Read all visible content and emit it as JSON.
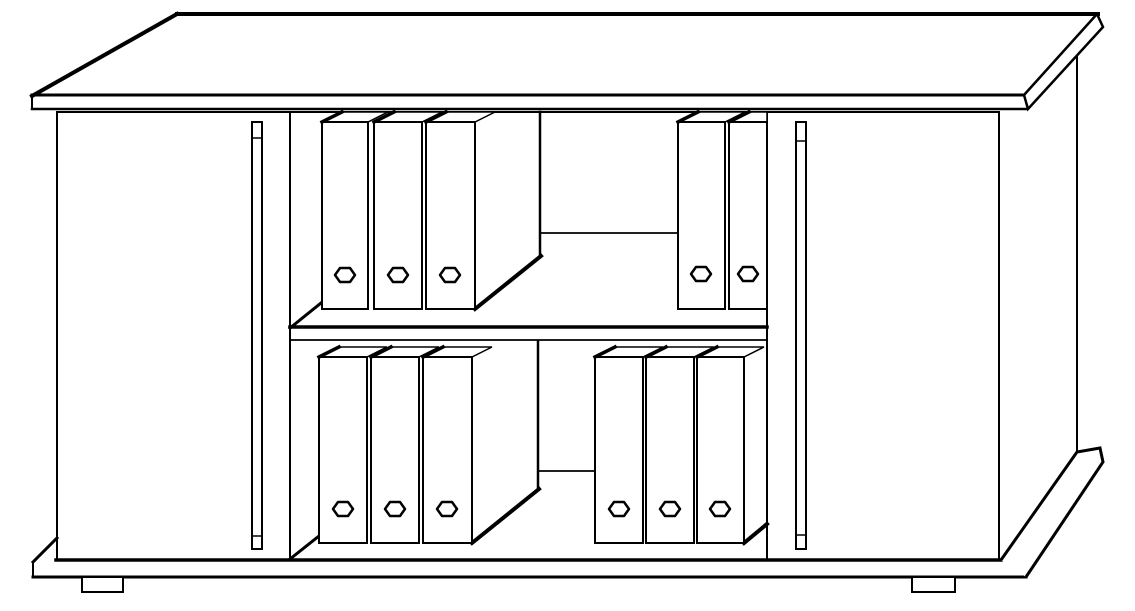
{
  "figure": {
    "description": "Black-and-white line drawing of a sideboard cabinet with two closed doors, an open middle bay with one shelf, and eleven ring binders",
    "binder_count": 11,
    "door_count": 2,
    "shelf_count": 1
  },
  "drawing": {
    "background": "#ffffff",
    "ink": "#000000",
    "width": 1135,
    "height": 611,
    "shapes": [
      {
        "type": "line",
        "name": "tabletop-back-edge",
        "x1": 177,
        "y1": 14,
        "x2": 1098,
        "y2": 14,
        "w": 4
      },
      {
        "type": "line",
        "name": "tabletop-left-edge",
        "x1": 32,
        "y1": 96,
        "x2": 177,
        "y2": 14,
        "w": 4
      },
      {
        "type": "line",
        "name": "tabletop-front-edge",
        "x1": 32,
        "y1": 95,
        "x2": 1024,
        "y2": 95,
        "w": 3
      },
      {
        "type": "line",
        "name": "tabletop-front-band-bottom",
        "x1": 32,
        "y1": 109,
        "x2": 1026,
        "y2": 109,
        "w": 2.5
      },
      {
        "type": "line",
        "name": "tabletop-left-end-cap",
        "x1": 32,
        "y1": 95,
        "x2": 32,
        "y2": 109,
        "w": 2
      },
      {
        "type": "polygon",
        "name": "tabletop-right-end-face",
        "points": [
          [
            1024,
            95
          ],
          [
            1097,
            14
          ],
          [
            1103,
            27
          ],
          [
            1028,
            109
          ]
        ],
        "w": 2.5
      },
      {
        "type": "line",
        "name": "carcass-top-edge",
        "x1": 57,
        "y1": 112,
        "x2": 999,
        "y2": 112,
        "w": 2
      },
      {
        "type": "line",
        "name": "carcass-left-edge",
        "x1": 57,
        "y1": 112,
        "x2": 57,
        "y2": 560,
        "w": 2
      },
      {
        "type": "line",
        "name": "left-door-right-edge",
        "x1": 290,
        "y1": 112,
        "x2": 290,
        "y2": 560,
        "w": 2
      },
      {
        "type": "line",
        "name": "right-door-left-edge",
        "x1": 767,
        "y1": 112,
        "x2": 767,
        "y2": 560,
        "w": 2
      },
      {
        "type": "line",
        "name": "right-door-right-edge",
        "x1": 999,
        "y1": 112,
        "x2": 999,
        "y2": 560,
        "w": 2
      },
      {
        "type": "line",
        "name": "carcass-right-silhouette",
        "x1": 1077,
        "y1": 57,
        "x2": 1077,
        "y2": 452,
        "w": 2
      },
      {
        "type": "line",
        "name": "carcass-bottom-edge",
        "x1": 56,
        "y1": 560,
        "x2": 1001,
        "y2": 560,
        "w": 3.5
      },
      {
        "type": "rect",
        "name": "left-door-handle",
        "x": 252,
        "y": 122,
        "wd": 10,
        "h": 427,
        "w": 2
      },
      {
        "type": "line",
        "name": "left-door-handle-top-cap",
        "x1": 252,
        "y1": 138,
        "x2": 262,
        "y2": 138,
        "w": 1.5
      },
      {
        "type": "line",
        "name": "left-door-handle-bottom-cap",
        "x1": 252,
        "y1": 536,
        "x2": 262,
        "y2": 536,
        "w": 1.5
      },
      {
        "type": "rect",
        "name": "right-door-handle",
        "x": 796,
        "y": 122,
        "wd": 10,
        "h": 427,
        "w": 2
      },
      {
        "type": "line",
        "name": "right-door-handle-top-cap",
        "x1": 796,
        "y1": 141,
        "x2": 806,
        "y2": 141,
        "w": 1.5
      },
      {
        "type": "line",
        "name": "right-door-handle-bottom-cap",
        "x1": 796,
        "y1": 535,
        "x2": 806,
        "y2": 535,
        "w": 1.5
      },
      {
        "type": "line",
        "name": "shelf-front-edge",
        "x1": 290,
        "y1": 327,
        "x2": 767,
        "y2": 327,
        "w": 3.5
      },
      {
        "type": "line",
        "name": "shelf-front-band-bottom",
        "x1": 290,
        "y1": 340,
        "x2": 767,
        "y2": 340,
        "w": 1.8
      },
      {
        "type": "line",
        "name": "upper-shelf-left-corner-diagonal",
        "x1": 290,
        "y1": 328,
        "x2": 321,
        "y2": 303,
        "w": 3
      },
      {
        "type": "line",
        "name": "upper-binder-block-back-edge",
        "x1": 540,
        "y1": 112,
        "x2": 540,
        "y2": 257,
        "w": 2.5
      },
      {
        "type": "line",
        "name": "upper-back-wall-shelf-junction",
        "x1": 540,
        "y1": 233,
        "x2": 678,
        "y2": 233,
        "w": 1.8
      },
      {
        "type": "line",
        "name": "upper-binder-block-side-bottom-diagonal",
        "x1": 475,
        "y1": 309,
        "x2": 541,
        "y2": 256,
        "w": 4
      },
      {
        "type": "line",
        "name": "lower-floor-left-corner-diagonal",
        "x1": 290,
        "y1": 559,
        "x2": 319,
        "y2": 536,
        "w": 3
      },
      {
        "type": "line",
        "name": "lower-binder-block-back-edge",
        "x1": 538,
        "y1": 341,
        "x2": 538,
        "y2": 490,
        "w": 2.5
      },
      {
        "type": "line",
        "name": "lower-back-wall-floor-junction",
        "x1": 538,
        "y1": 471,
        "x2": 595,
        "y2": 471,
        "w": 1.8
      },
      {
        "type": "line",
        "name": "lower-binder-block-side-bottom-diagonal",
        "x1": 472,
        "y1": 543,
        "x2": 539,
        "y2": 489,
        "w": 4
      },
      {
        "type": "line",
        "name": "lower-right-binder-side-bottom-diagonal",
        "x1": 744,
        "y1": 543,
        "x2": 767,
        "y2": 524,
        "w": 4
      },
      {
        "type": "polygon",
        "name": "binder-top-upper-left-1",
        "points": [
          [
            322,
            122
          ],
          [
            342,
            112
          ],
          [
            388,
            112
          ],
          [
            368,
            122
          ]
        ],
        "w": 1.5
      },
      {
        "type": "rect",
        "name": "binder-front-upper-left-1",
        "x": 322,
        "y": 122,
        "wd": 46,
        "h": 187,
        "w": 2
      },
      {
        "type": "line",
        "name": "binder-spine-edge-upper-left-1",
        "x1": 322,
        "y1": 122,
        "x2": 342,
        "y2": 112,
        "w": 3.5
      },
      {
        "type": "hex",
        "name": "binder-grip-hole-upper-left-1",
        "cx": 345,
        "cy": 275,
        "rx": 10,
        "ry": 7,
        "w": 2.5
      },
      {
        "type": "polygon",
        "name": "binder-top-upper-left-2",
        "points": [
          [
            374,
            122
          ],
          [
            394,
            112
          ],
          [
            442,
            112
          ],
          [
            422,
            122
          ]
        ],
        "w": 1.5
      },
      {
        "type": "rect",
        "name": "binder-front-upper-left-2",
        "x": 374,
        "y": 122,
        "wd": 48,
        "h": 187,
        "w": 2
      },
      {
        "type": "line",
        "name": "binder-spine-edge-upper-left-2",
        "x1": 374,
        "y1": 122,
        "x2": 394,
        "y2": 112,
        "w": 3.5
      },
      {
        "type": "hex",
        "name": "binder-grip-hole-upper-left-2",
        "cx": 398,
        "cy": 275,
        "rx": 10,
        "ry": 7,
        "w": 2.5
      },
      {
        "type": "polygon",
        "name": "binder-top-upper-left-3",
        "points": [
          [
            426,
            122
          ],
          [
            446,
            112
          ],
          [
            495,
            112
          ],
          [
            475,
            122
          ]
        ],
        "w": 1.5
      },
      {
        "type": "rect",
        "name": "binder-front-upper-left-3",
        "x": 426,
        "y": 122,
        "wd": 49,
        "h": 187,
        "w": 2
      },
      {
        "type": "line",
        "name": "binder-spine-edge-upper-left-3",
        "x1": 426,
        "y1": 122,
        "x2": 446,
        "y2": 112,
        "w": 3.5
      },
      {
        "type": "hex",
        "name": "binder-grip-hole-upper-left-3",
        "cx": 450,
        "cy": 275,
        "rx": 10,
        "ry": 7,
        "w": 2.5
      },
      {
        "type": "polygon",
        "name": "binder-top-upper-right-1",
        "points": [
          [
            678,
            122
          ],
          [
            698,
            112
          ],
          [
            745,
            112
          ],
          [
            725,
            122
          ]
        ],
        "w": 1.5
      },
      {
        "type": "rect",
        "name": "binder-front-upper-right-1",
        "x": 678,
        "y": 122,
        "wd": 47,
        "h": 187,
        "w": 2
      },
      {
        "type": "line",
        "name": "binder-spine-edge-upper-right-1",
        "x1": 678,
        "y1": 122,
        "x2": 698,
        "y2": 112,
        "w": 3.5
      },
      {
        "type": "hex",
        "name": "binder-grip-hole-upper-right-1",
        "cx": 701,
        "cy": 274,
        "rx": 10,
        "ry": 7,
        "w": 2.5
      },
      {
        "type": "polygon",
        "name": "binder-top-upper-right-2",
        "points": [
          [
            729,
            122
          ],
          [
            749,
            112
          ],
          [
            767,
            112
          ],
          [
            767,
            122
          ]
        ],
        "w": 1.5
      },
      {
        "type": "rect",
        "name": "binder-front-upper-right-2",
        "x": 729,
        "y": 122,
        "wd": 38,
        "h": 187,
        "w": 2
      },
      {
        "type": "line",
        "name": "binder-spine-edge-upper-right-2",
        "x1": 729,
        "y1": 122,
        "x2": 749,
        "y2": 112,
        "w": 3.5
      },
      {
        "type": "hex",
        "name": "binder-grip-hole-upper-right-2",
        "cx": 748,
        "cy": 274,
        "rx": 10,
        "ry": 7,
        "w": 2.5
      },
      {
        "type": "polygon",
        "name": "binder-top-lower-left-1",
        "points": [
          [
            319,
            357
          ],
          [
            339,
            347
          ],
          [
            387,
            347
          ],
          [
            367,
            357
          ]
        ],
        "w": 1.5
      },
      {
        "type": "rect",
        "name": "binder-front-lower-left-1",
        "x": 319,
        "y": 357,
        "wd": 48,
        "h": 186,
        "w": 2
      },
      {
        "type": "line",
        "name": "binder-spine-edge-lower-left-1",
        "x1": 319,
        "y1": 357,
        "x2": 339,
        "y2": 347,
        "w": 3.5
      },
      {
        "type": "hex",
        "name": "binder-grip-hole-lower-left-1",
        "cx": 343,
        "cy": 509,
        "rx": 10,
        "ry": 7,
        "w": 2.5
      },
      {
        "type": "polygon",
        "name": "binder-top-lower-left-2",
        "points": [
          [
            371,
            357
          ],
          [
            391,
            347
          ],
          [
            439,
            347
          ],
          [
            419,
            357
          ]
        ],
        "w": 1.5
      },
      {
        "type": "rect",
        "name": "binder-front-lower-left-2",
        "x": 371,
        "y": 357,
        "wd": 48,
        "h": 186,
        "w": 2
      },
      {
        "type": "line",
        "name": "binder-spine-edge-lower-left-2",
        "x1": 371,
        "y1": 357,
        "x2": 391,
        "y2": 347,
        "w": 3.5
      },
      {
        "type": "hex",
        "name": "binder-grip-hole-lower-left-2",
        "cx": 395,
        "cy": 509,
        "rx": 10,
        "ry": 7,
        "w": 2.5
      },
      {
        "type": "polygon",
        "name": "binder-top-lower-left-3",
        "points": [
          [
            423,
            357
          ],
          [
            443,
            347
          ],
          [
            492,
            347
          ],
          [
            472,
            357
          ]
        ],
        "w": 1.5
      },
      {
        "type": "rect",
        "name": "binder-front-lower-left-3",
        "x": 423,
        "y": 357,
        "wd": 49,
        "h": 186,
        "w": 2
      },
      {
        "type": "line",
        "name": "binder-spine-edge-lower-left-3",
        "x1": 423,
        "y1": 357,
        "x2": 443,
        "y2": 347,
        "w": 3.5
      },
      {
        "type": "hex",
        "name": "binder-grip-hole-lower-left-3",
        "cx": 447,
        "cy": 509,
        "rx": 10,
        "ry": 7,
        "w": 2.5
      },
      {
        "type": "polygon",
        "name": "binder-top-lower-right-1",
        "points": [
          [
            595,
            357
          ],
          [
            615,
            347
          ],
          [
            663,
            347
          ],
          [
            643,
            357
          ]
        ],
        "w": 1.5
      },
      {
        "type": "rect",
        "name": "binder-front-lower-right-1",
        "x": 595,
        "y": 357,
        "wd": 48,
        "h": 186,
        "w": 2
      },
      {
        "type": "line",
        "name": "binder-spine-edge-lower-right-1",
        "x1": 595,
        "y1": 357,
        "x2": 615,
        "y2": 347,
        "w": 3.5
      },
      {
        "type": "hex",
        "name": "binder-grip-hole-lower-right-1",
        "cx": 619,
        "cy": 509,
        "rx": 10,
        "ry": 7,
        "w": 2.5
      },
      {
        "type": "polygon",
        "name": "binder-top-lower-right-2",
        "points": [
          [
            646,
            357
          ],
          [
            666,
            347
          ],
          [
            714,
            347
          ],
          [
            694,
            357
          ]
        ],
        "w": 1.5
      },
      {
        "type": "rect",
        "name": "binder-front-lower-right-2",
        "x": 646,
        "y": 357,
        "wd": 48,
        "h": 186,
        "w": 2
      },
      {
        "type": "line",
        "name": "binder-spine-edge-lower-right-2",
        "x1": 646,
        "y1": 357,
        "x2": 666,
        "y2": 347,
        "w": 3.5
      },
      {
        "type": "hex",
        "name": "binder-grip-hole-lower-right-2",
        "cx": 670,
        "cy": 509,
        "rx": 10,
        "ry": 7,
        "w": 2.5
      },
      {
        "type": "polygon",
        "name": "binder-top-lower-right-3",
        "points": [
          [
            697,
            357
          ],
          [
            717,
            347
          ],
          [
            764,
            347
          ],
          [
            744,
            357
          ]
        ],
        "w": 1.5
      },
      {
        "type": "rect",
        "name": "binder-front-lower-right-3",
        "x": 697,
        "y": 357,
        "wd": 47,
        "h": 186,
        "w": 2
      },
      {
        "type": "line",
        "name": "binder-spine-edge-lower-right-3",
        "x1": 697,
        "y1": 357,
        "x2": 717,
        "y2": 347,
        "w": 3.5
      },
      {
        "type": "hex",
        "name": "binder-grip-hole-lower-right-3",
        "cx": 720,
        "cy": 509,
        "rx": 10,
        "ry": 7,
        "w": 2.5
      },
      {
        "type": "line",
        "name": "plinth-left-end-diagonal",
        "x1": 33,
        "y1": 562,
        "x2": 57,
        "y2": 538,
        "w": 3
      },
      {
        "type": "line",
        "name": "plinth-left-end-cap",
        "x1": 33,
        "y1": 562,
        "x2": 33,
        "y2": 577,
        "w": 2
      },
      {
        "type": "line",
        "name": "plinth-bottom-edge",
        "x1": 33,
        "y1": 577,
        "x2": 1026,
        "y2": 577,
        "w": 3
      },
      {
        "type": "path",
        "name": "plinth-right-end",
        "d": "M1001,560 L1077,452 L1100,448 L1103,462 L1026,577",
        "w": 3,
        "fill": "#ffffff"
      },
      {
        "type": "rect",
        "name": "left-foot",
        "x": 82,
        "y": 577,
        "wd": 41,
        "h": 15,
        "w": 2
      },
      {
        "type": "rect",
        "name": "right-foot",
        "x": 912,
        "y": 577,
        "wd": 43,
        "h": 15,
        "w": 2
      }
    ]
  }
}
